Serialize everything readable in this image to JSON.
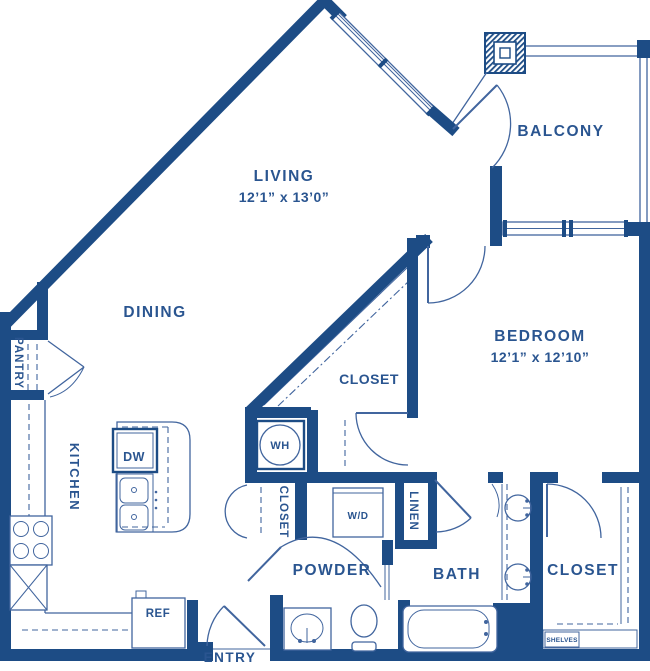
{
  "colors": {
    "wall": "#1d4c85",
    "text": "#2a5590",
    "thin_line": "#41659e",
    "background": "#ffffff"
  },
  "rooms": {
    "living": {
      "label": "LIVING",
      "dimensions": "12’1” x 13’0”"
    },
    "dining": {
      "label": "DINING"
    },
    "bedroom": {
      "label": "BEDROOM",
      "dimensions": "12’1” x 12’10”"
    },
    "balcony": {
      "label": "BALCONY"
    },
    "kitchen": {
      "label": "KITCHEN"
    },
    "pantry": {
      "label": "PANTRY"
    },
    "entry": {
      "label": "ENTRY"
    },
    "powder": {
      "label": "POWDER"
    },
    "bath": {
      "label": "BATH"
    },
    "linen": {
      "label": "LINEN"
    },
    "closet_triangular": {
      "label": "CLOSET"
    },
    "closet_hall": {
      "label": "CLOSET"
    },
    "closet_bedroom": {
      "label": "CLOSET"
    }
  },
  "fixtures": {
    "dishwasher_label": "DW",
    "water_heater_label": "WH",
    "washer_dryer_label": "W/D",
    "refrigerator_label": "REF",
    "shelves_label": "SHELVES"
  }
}
